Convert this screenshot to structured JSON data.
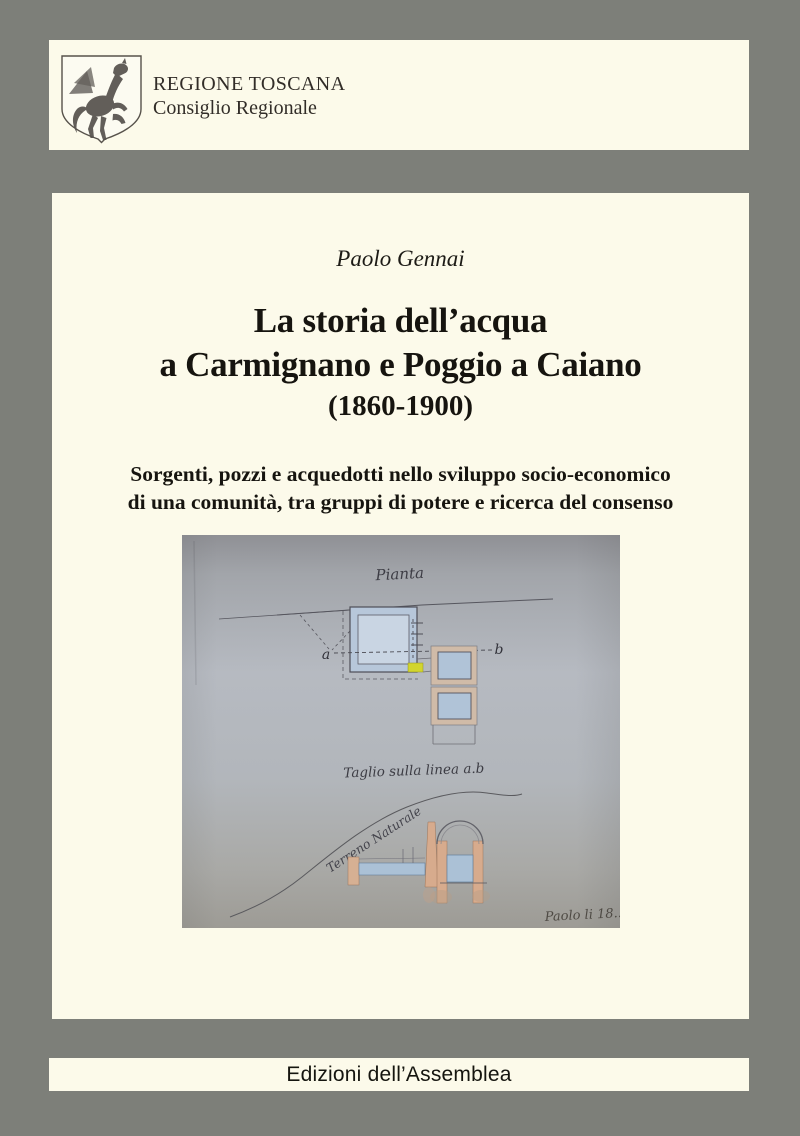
{
  "page": {
    "background_color": "#7d7f79",
    "paper_color": "#fcfaea"
  },
  "header": {
    "region": "REGIONE TOSCANA",
    "council": "Consiglio Regionale"
  },
  "cover": {
    "author": "Paolo Gennai",
    "title_line1": "La storia dell’acqua",
    "title_line2": "a Carmignano e Poggio a Caiano",
    "years": "(1860-1900)",
    "subtitle_line1": "Sorgenti, pozzi e acquedotti nello sviluppo socio-economico",
    "subtitle_line2": "di una comunità, tra gruppi di potere e ricerca del consenso"
  },
  "drawing": {
    "plan_label": "Pianta",
    "point_a": "a",
    "point_b": "b",
    "section_label": "Taglio sulla linea a.b",
    "terrain_label": "Terreno Naturale",
    "signature": "Paolo li 18..",
    "paper_color": "#b2b6bc",
    "water_color": "#aec2d6",
    "wall_color": "#d6ab8e",
    "highlight_color": "#d2d52e"
  },
  "footer": {
    "imprint": "Edizioni dell’Assemblea"
  }
}
